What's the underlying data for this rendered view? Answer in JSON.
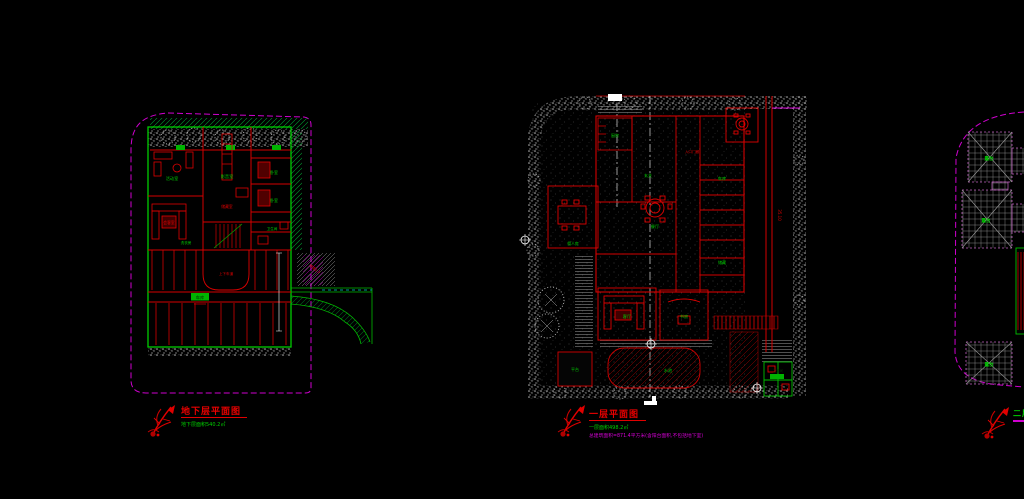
{
  "sheet": {
    "type": "CAD drawing sheet",
    "background": "#000000"
  },
  "colors": {
    "red": "#e00000",
    "dark_red": "#b00000",
    "green": "#00d000",
    "magenta": "#d400d4",
    "cyan": "#00cccc",
    "white": "#ffffff",
    "gray": "#9a9a9a"
  },
  "plans": {
    "basement": {
      "title": "地下层平面图",
      "subtitle": "地下层面积540.2㎡",
      "labels": [
        "活动室",
        "影音室",
        "卧室",
        "卧室",
        "卫生间",
        "洗衣房",
        "储藏室",
        "上下车道",
        "车库",
        "坡道1:7",
        "会客室"
      ]
    },
    "first": {
      "title": "一层平面图",
      "subtitle_area": "一层面积498.2㎡",
      "subtitle_total": "总建筑面积=871.4平方米(含阳台面积,不包括地下室)",
      "labels": [
        "厨房",
        "餐厅",
        "客厅",
        "书房",
        "车库",
        "储藏",
        "水池",
        "佣人房",
        "入口门廊",
        "平台",
        "玄关",
        "卫生间"
      ],
      "dim_road": "35.10"
    },
    "second": {
      "title": "二层平面图",
      "labels": [
        "露台",
        "露台",
        "露台"
      ]
    }
  }
}
